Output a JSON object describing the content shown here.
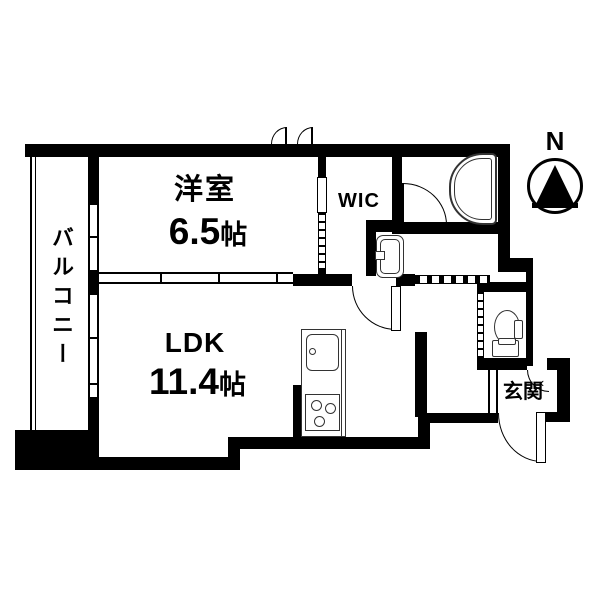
{
  "rooms": {
    "western": {
      "name": "洋室",
      "size_value": "6.5",
      "size_unit": "帖"
    },
    "ldk": {
      "name": "LDK",
      "size_value": "11.4",
      "size_unit": "帖"
    },
    "wic": {
      "name": "WIC"
    },
    "balcony": {
      "name": "バルコニー"
    },
    "entrance": {
      "name": "玄関"
    }
  },
  "compass": {
    "north_label": "N"
  },
  "entrance_arrow": "‹",
  "colors": {
    "wall": "#000000",
    "background": "#ffffff"
  },
  "fixtures": [
    "bathtub",
    "bath-door",
    "toilet",
    "washbasin",
    "kitchen-sink",
    "gas-stove",
    "balcony-windows",
    "sliding-partition",
    "entrance-door",
    "north-compass"
  ]
}
